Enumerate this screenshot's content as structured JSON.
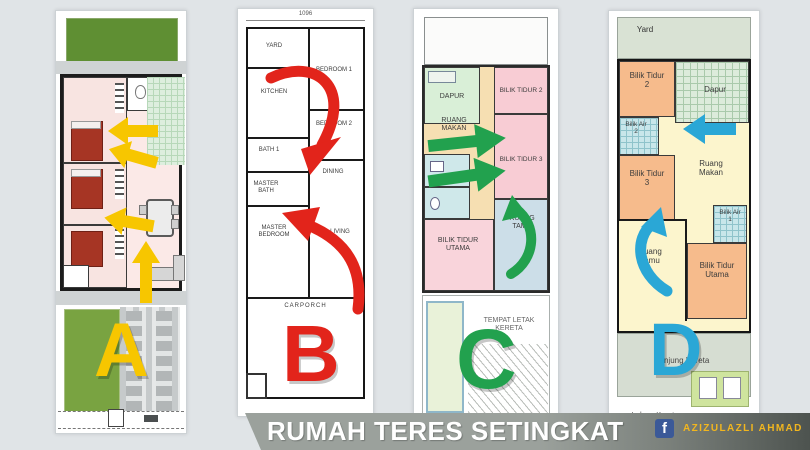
{
  "background_color": "#e0e4e7",
  "caption": {
    "text": "RUMAH TERES SETINGKAT",
    "band_color": "#9ba19c",
    "text_color": "#ffffff"
  },
  "attribution": {
    "icon": "facebook-icon",
    "name": "AZIZULAZLI AHMAD",
    "name_color": "#f2b61e",
    "icon_color": "#3b5998"
  },
  "plans": {
    "a": {
      "letter": "A",
      "accent": "#f7c600"
    },
    "b": {
      "letter": "B",
      "accent": "#e2241b",
      "dimension": "1096",
      "rooms": {
        "yard": "YARD",
        "kitchen": "KITCHEN",
        "bedroom1": "BEDROOM 1",
        "bedroom2": "BEDROOM 2",
        "bath1": "BATH 1",
        "dining": "DINING",
        "master_bath": "MASTER BATH",
        "master_bedroom": "MASTER BEDROOM",
        "living": "LIVING",
        "carporch": "CARPORCH"
      }
    },
    "c": {
      "letter": "C",
      "accent": "#22a14e",
      "rooms": {
        "dapur": "DAPUR",
        "bilik_tidur_2": "BILIK TIDUR 2",
        "bilik_tidur_3": "BILIK TIDUR 3",
        "ruang_makan": "RUANG MAKAN",
        "bilik_tidur_utama": "BILIK TIDUR UTAMA",
        "ruang_tamu": "RUANG TAMU",
        "tempat_letak_kereta": "TEMPAT LETAK KERETA"
      }
    },
    "d": {
      "letter": "D",
      "accent": "#2aa7d6",
      "rooms": {
        "yard": "Yard",
        "bilik_tidur_2": "Bilik Tidur 2",
        "dapur": "Dapur",
        "bilik_air_2": "Bilik Air 2",
        "bilik_tidur_3": "Bilik Tidur 3",
        "ruang_makan": "Ruang Makan",
        "ruang_tamu": "Ruang Tamu",
        "bilik_air_1": "Bilik Air 1",
        "bilik_tidur_utama": "Bilik Tidur Utama",
        "anjung_kereta": "Anjung Kereta",
        "laluan_kereta": "Laluan Kereta"
      }
    }
  }
}
